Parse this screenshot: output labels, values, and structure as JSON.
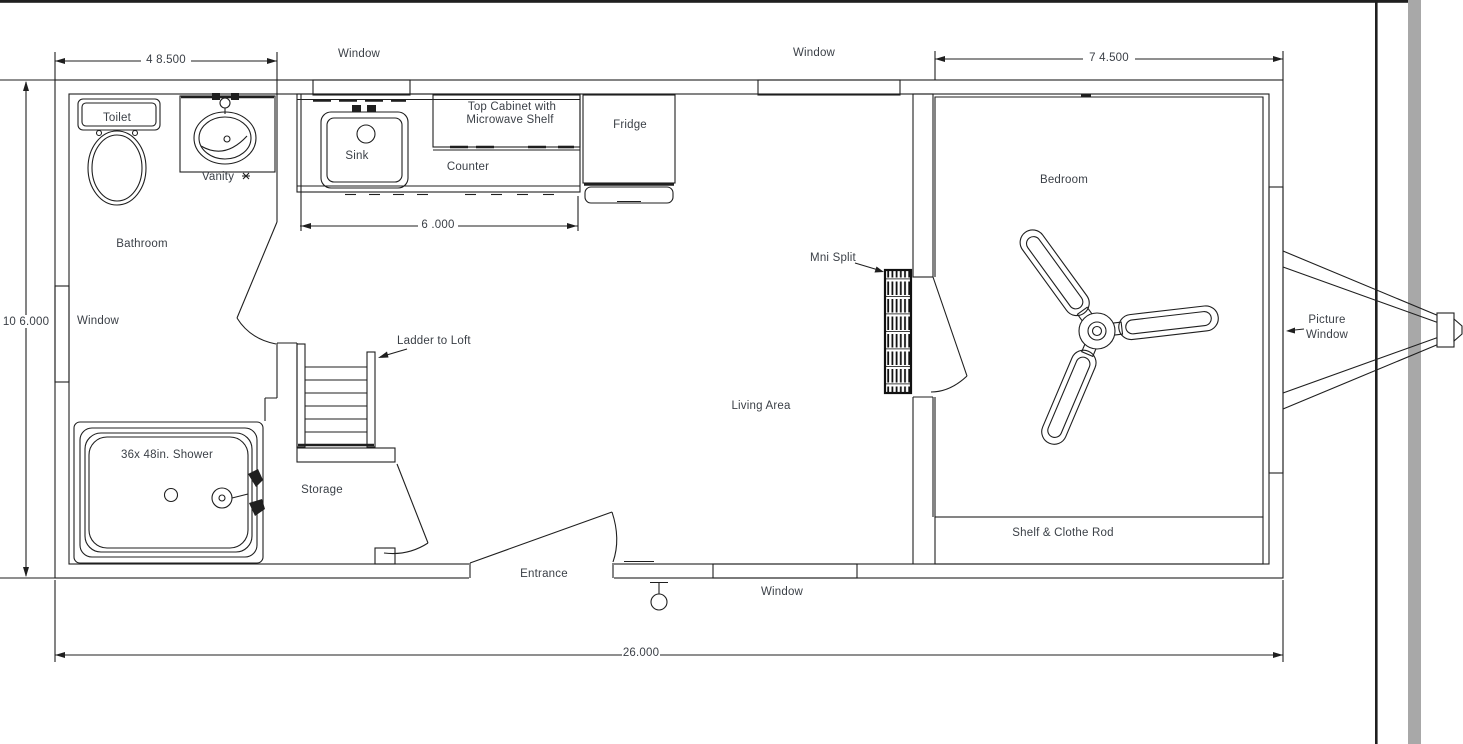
{
  "colors": {
    "line": "#1f1f1f",
    "text": "#3a3f46",
    "gray_bar": "#a8a8a8",
    "background": "#ffffff"
  },
  "rooms": {
    "bathroom": "Bathroom",
    "living_area": "Living Area",
    "bedroom": "Bedroom",
    "storage": "Storage"
  },
  "windows": {
    "top_left": "Window",
    "top_right": "Window",
    "left": "Window",
    "bottom": "Window"
  },
  "fixtures": {
    "toilet": "Toilet",
    "vanity": "Vanity",
    "sink": "Sink",
    "top_cabinet_line1": "Top Cabinet with",
    "top_cabinet_line2": "Microwave Shelf",
    "counter": "Counter",
    "fridge": "Fridge",
    "shower": "36x 48in. Shower",
    "ladder": "Ladder to Loft",
    "mini_split": "Mni Split",
    "entrance": "Entrance",
    "shelf_rod": "Shelf & Clothe Rod",
    "picture_window_line1": "Picture",
    "picture_window_line2": "Window"
  },
  "dimensions": {
    "bathroom_width": "4 8.500",
    "bedroom_width": "7 4.500",
    "house_width": "10 6.000",
    "kitchen_run": "6 .000",
    "house_length": "26.000"
  }
}
